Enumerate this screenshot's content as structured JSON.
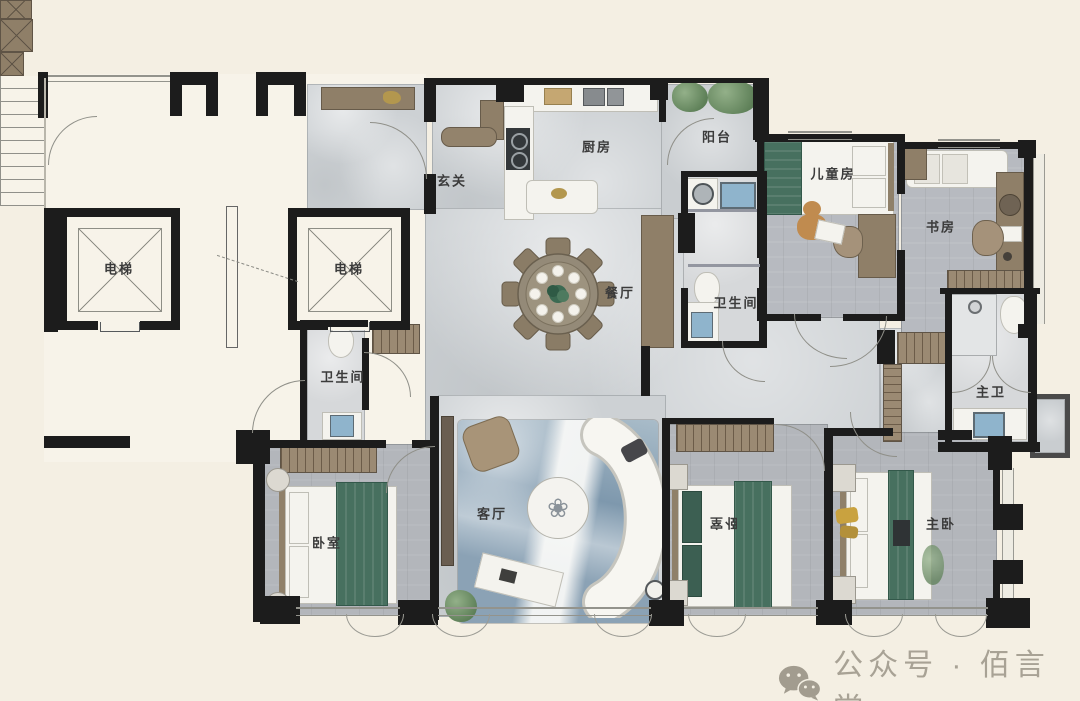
{
  "canvas": {
    "width": 1080,
    "height": 701,
    "background": "#f4efe3"
  },
  "floorplan": {
    "type": "residential-floor-plan",
    "rooms": [
      {
        "id": "elevator-left",
        "label": "电梯"
      },
      {
        "id": "elevator-right",
        "label": "电梯"
      },
      {
        "id": "foyer",
        "label": "玄关"
      },
      {
        "id": "kitchen",
        "label": "厨房"
      },
      {
        "id": "balcony",
        "label": "阳台"
      },
      {
        "id": "kids-room",
        "label": "儿童房"
      },
      {
        "id": "study",
        "label": "书房"
      },
      {
        "id": "dining-room",
        "label": "餐厅"
      },
      {
        "id": "bathroom",
        "label": "卫生间"
      },
      {
        "id": "bathroom-2",
        "label": "卫生间"
      },
      {
        "id": "master-bath",
        "label": "主卫"
      },
      {
        "id": "bedroom",
        "label": "卧室"
      },
      {
        "id": "living-room",
        "label": "客厅"
      },
      {
        "id": "bedroom-2",
        "label": "卧室"
      },
      {
        "id": "master-bedroom",
        "label": "主卧"
      }
    ],
    "colors": {
      "wall": "#1c1c1c",
      "marble_floor": "#cdd1d4",
      "wood_floor": "#b5b8bc",
      "bath_floor": "#d6d8da",
      "lobby_floor": "#f7f3e9",
      "balcony_floor": "#c9cdd0",
      "bedding_green": "#47705f",
      "rug_blue": "#7e98ad",
      "cabinet_brown": "#8f7f68",
      "watermark_gray": "#a8a295"
    }
  },
  "watermark": {
    "icon": "wechat-icon",
    "text": "公众号 · 佰言堂"
  }
}
